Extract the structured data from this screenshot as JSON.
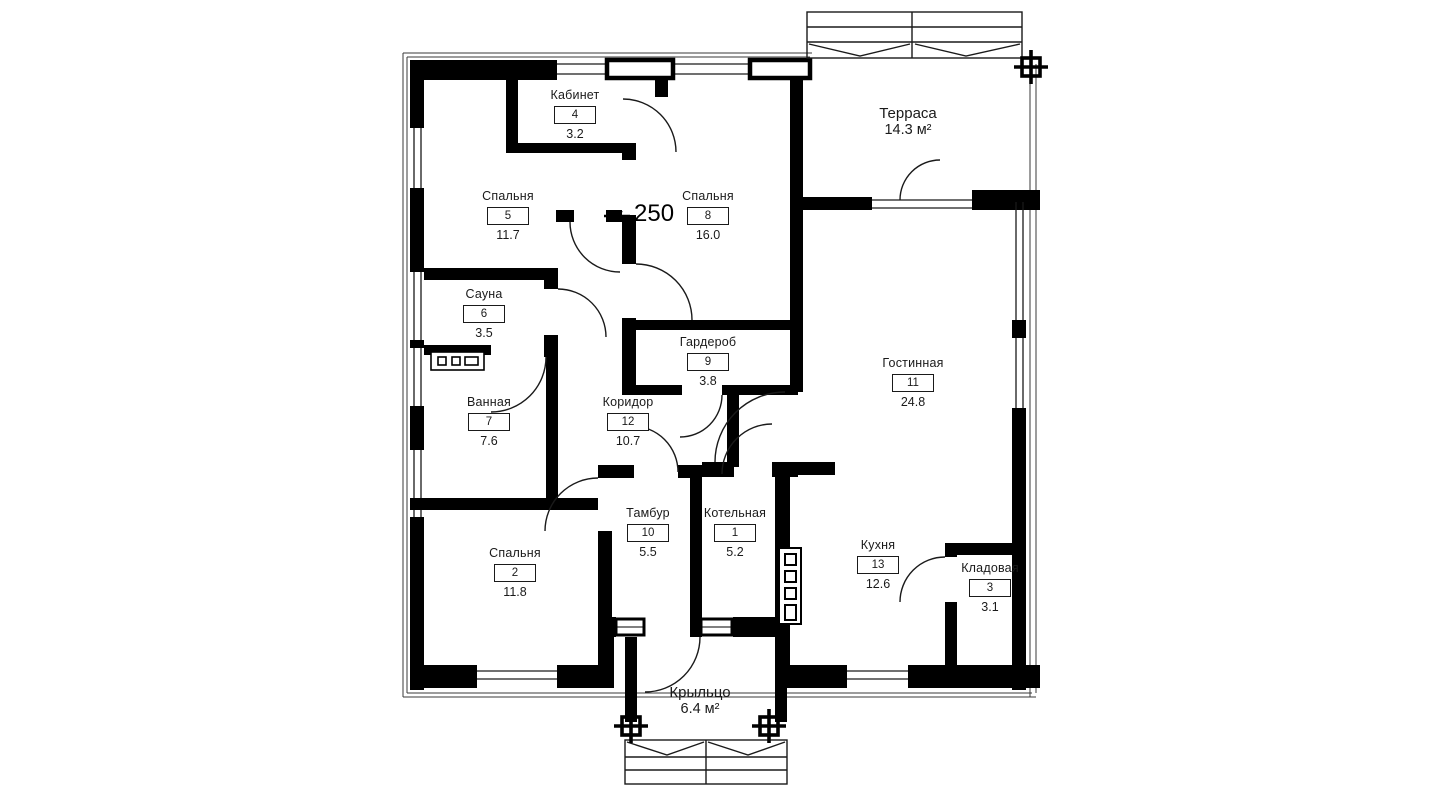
{
  "title": "Floor plan",
  "dimension": {
    "wall_thickness": "250"
  },
  "rooms": [
    {
      "name": "Кабинет",
      "number": "4",
      "area": "3.2"
    },
    {
      "name": "Спальня",
      "number": "5",
      "area": "11.7"
    },
    {
      "name": "Спальня",
      "number": "8",
      "area": "16.0"
    },
    {
      "name": "Сауна",
      "number": "6",
      "area": "3.5"
    },
    {
      "name": "Ванная",
      "number": "7",
      "area": "7.6"
    },
    {
      "name": "Гардероб",
      "number": "9",
      "area": "3.8"
    },
    {
      "name": "Коридор",
      "number": "12",
      "area": "10.7"
    },
    {
      "name": "Гостинная",
      "number": "11",
      "area": "24.8"
    },
    {
      "name": "Спальня",
      "number": "2",
      "area": "11.8"
    },
    {
      "name": "Тамбур",
      "number": "10",
      "area": "5.5"
    },
    {
      "name": "Котельная",
      "number": "1",
      "area": "5.2"
    },
    {
      "name": "Кухня",
      "number": "13",
      "area": "12.6"
    },
    {
      "name": "Кладовая",
      "number": "3",
      "area": "3.1"
    }
  ],
  "outdoor": [
    {
      "name": "Терраса",
      "area": "14.3 м²"
    },
    {
      "name": "Крыльцо",
      "area": "6.4 м²"
    }
  ],
  "colors": {
    "wall": "#000000",
    "background": "#ffffff",
    "line": "#1a1a1a"
  }
}
